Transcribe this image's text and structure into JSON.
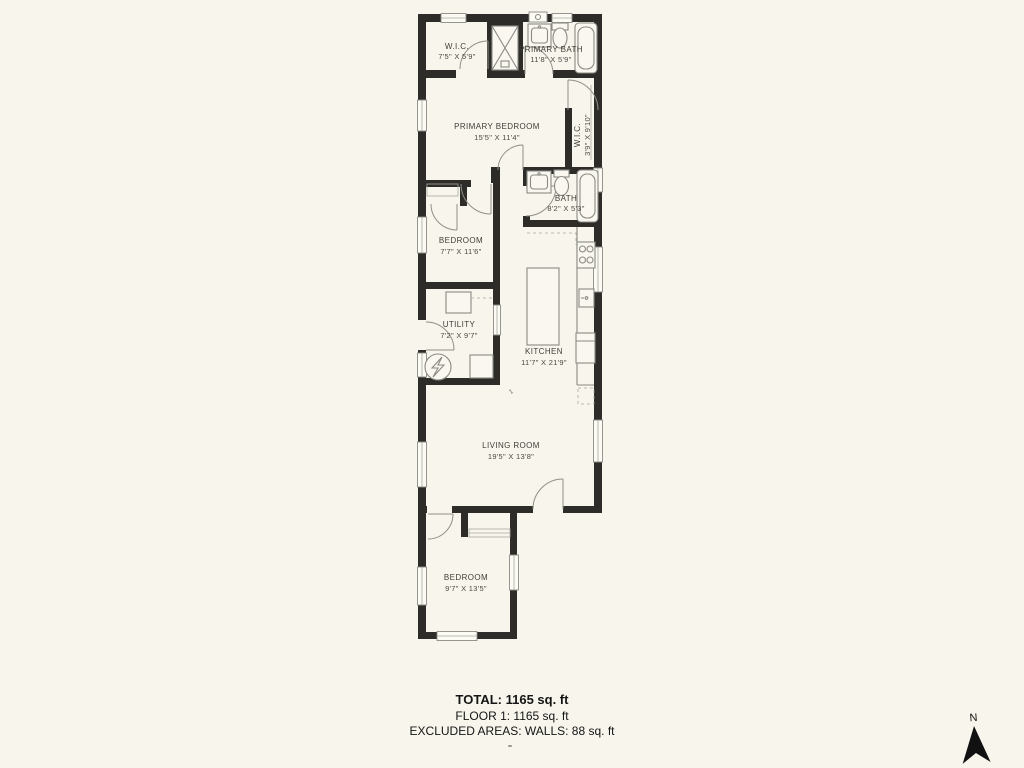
{
  "floorplan": {
    "rooms": [
      {
        "name": "W.I.C.",
        "dims": "7'5\" X 5'9\""
      },
      {
        "name": "PRIMARY BATH",
        "dims": "11'8\" X 5'9\""
      },
      {
        "name": "PRIMARY BEDROOM",
        "dims": "15'5\" X 11'4\""
      },
      {
        "name": "W.I.C.",
        "dims": "3'9\" X 9'10\""
      },
      {
        "name": "BATH",
        "dims": "8'2\" X 5'3\""
      },
      {
        "name": "BEDROOM",
        "dims": "7'7\" X 11'6\""
      },
      {
        "name": "UTILITY",
        "dims": "7'2\" X 9'7\""
      },
      {
        "name": "KITCHEN",
        "dims": "11'7\" X 21'9\""
      },
      {
        "name": "LIVING ROOM",
        "dims": "19'5\" X 13'8\""
      },
      {
        "name": "BEDROOM",
        "dims": "9'7\" X 13'5\""
      }
    ],
    "summary": {
      "total": "TOTAL: 1165 sq. ft",
      "floor": "FLOOR 1: 1165 sq. ft",
      "excluded": "EXCLUDED AREAS: WALLS: 88 sq. ft"
    },
    "compass": {
      "label": "N"
    },
    "colors": {
      "background": "#f7f5ec",
      "walls": "#2d2c28",
      "fixtures": "#8b8a83",
      "labels": "#3f3e39"
    }
  }
}
